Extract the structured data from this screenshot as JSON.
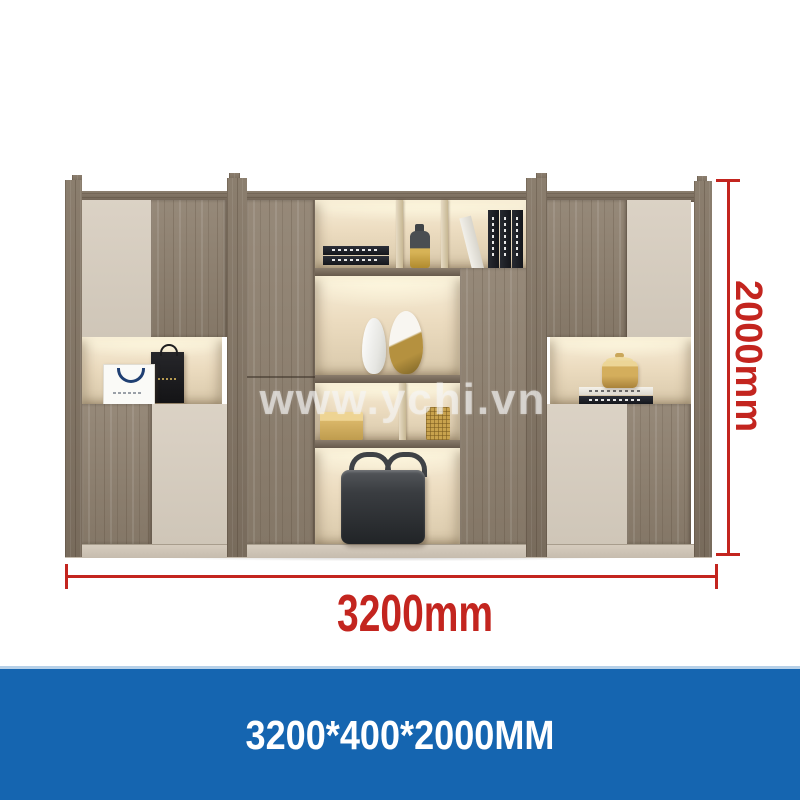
{
  "watermark": {
    "text": "www.ychi.vn"
  },
  "dimensions": {
    "width_label": "3200mm",
    "height_label": "2000mm"
  },
  "banner": {
    "text": "3200*400*2000MM"
  },
  "colors": {
    "dimension_red": "#c3251f",
    "banner_blue": "#1565b0",
    "banner_text": "#ffffff",
    "banner_top_line": "#b6d0e8",
    "wood": "#8e8172",
    "panel_beige": "#d7cec1",
    "niche_light": "#f6ecd6",
    "watermark_gray": "rgba(243,243,243,0.62)"
  },
  "decor_items": [
    "white-shopping-bag",
    "black-shopping-bag",
    "stacked-books",
    "gold-bottle",
    "vertical-books",
    "leaning-white-book",
    "white-vase",
    "gold-white-vase",
    "gold-box",
    "woven-gold-basket",
    "leather-briefcase",
    "gold-jar",
    "book-stack"
  ]
}
